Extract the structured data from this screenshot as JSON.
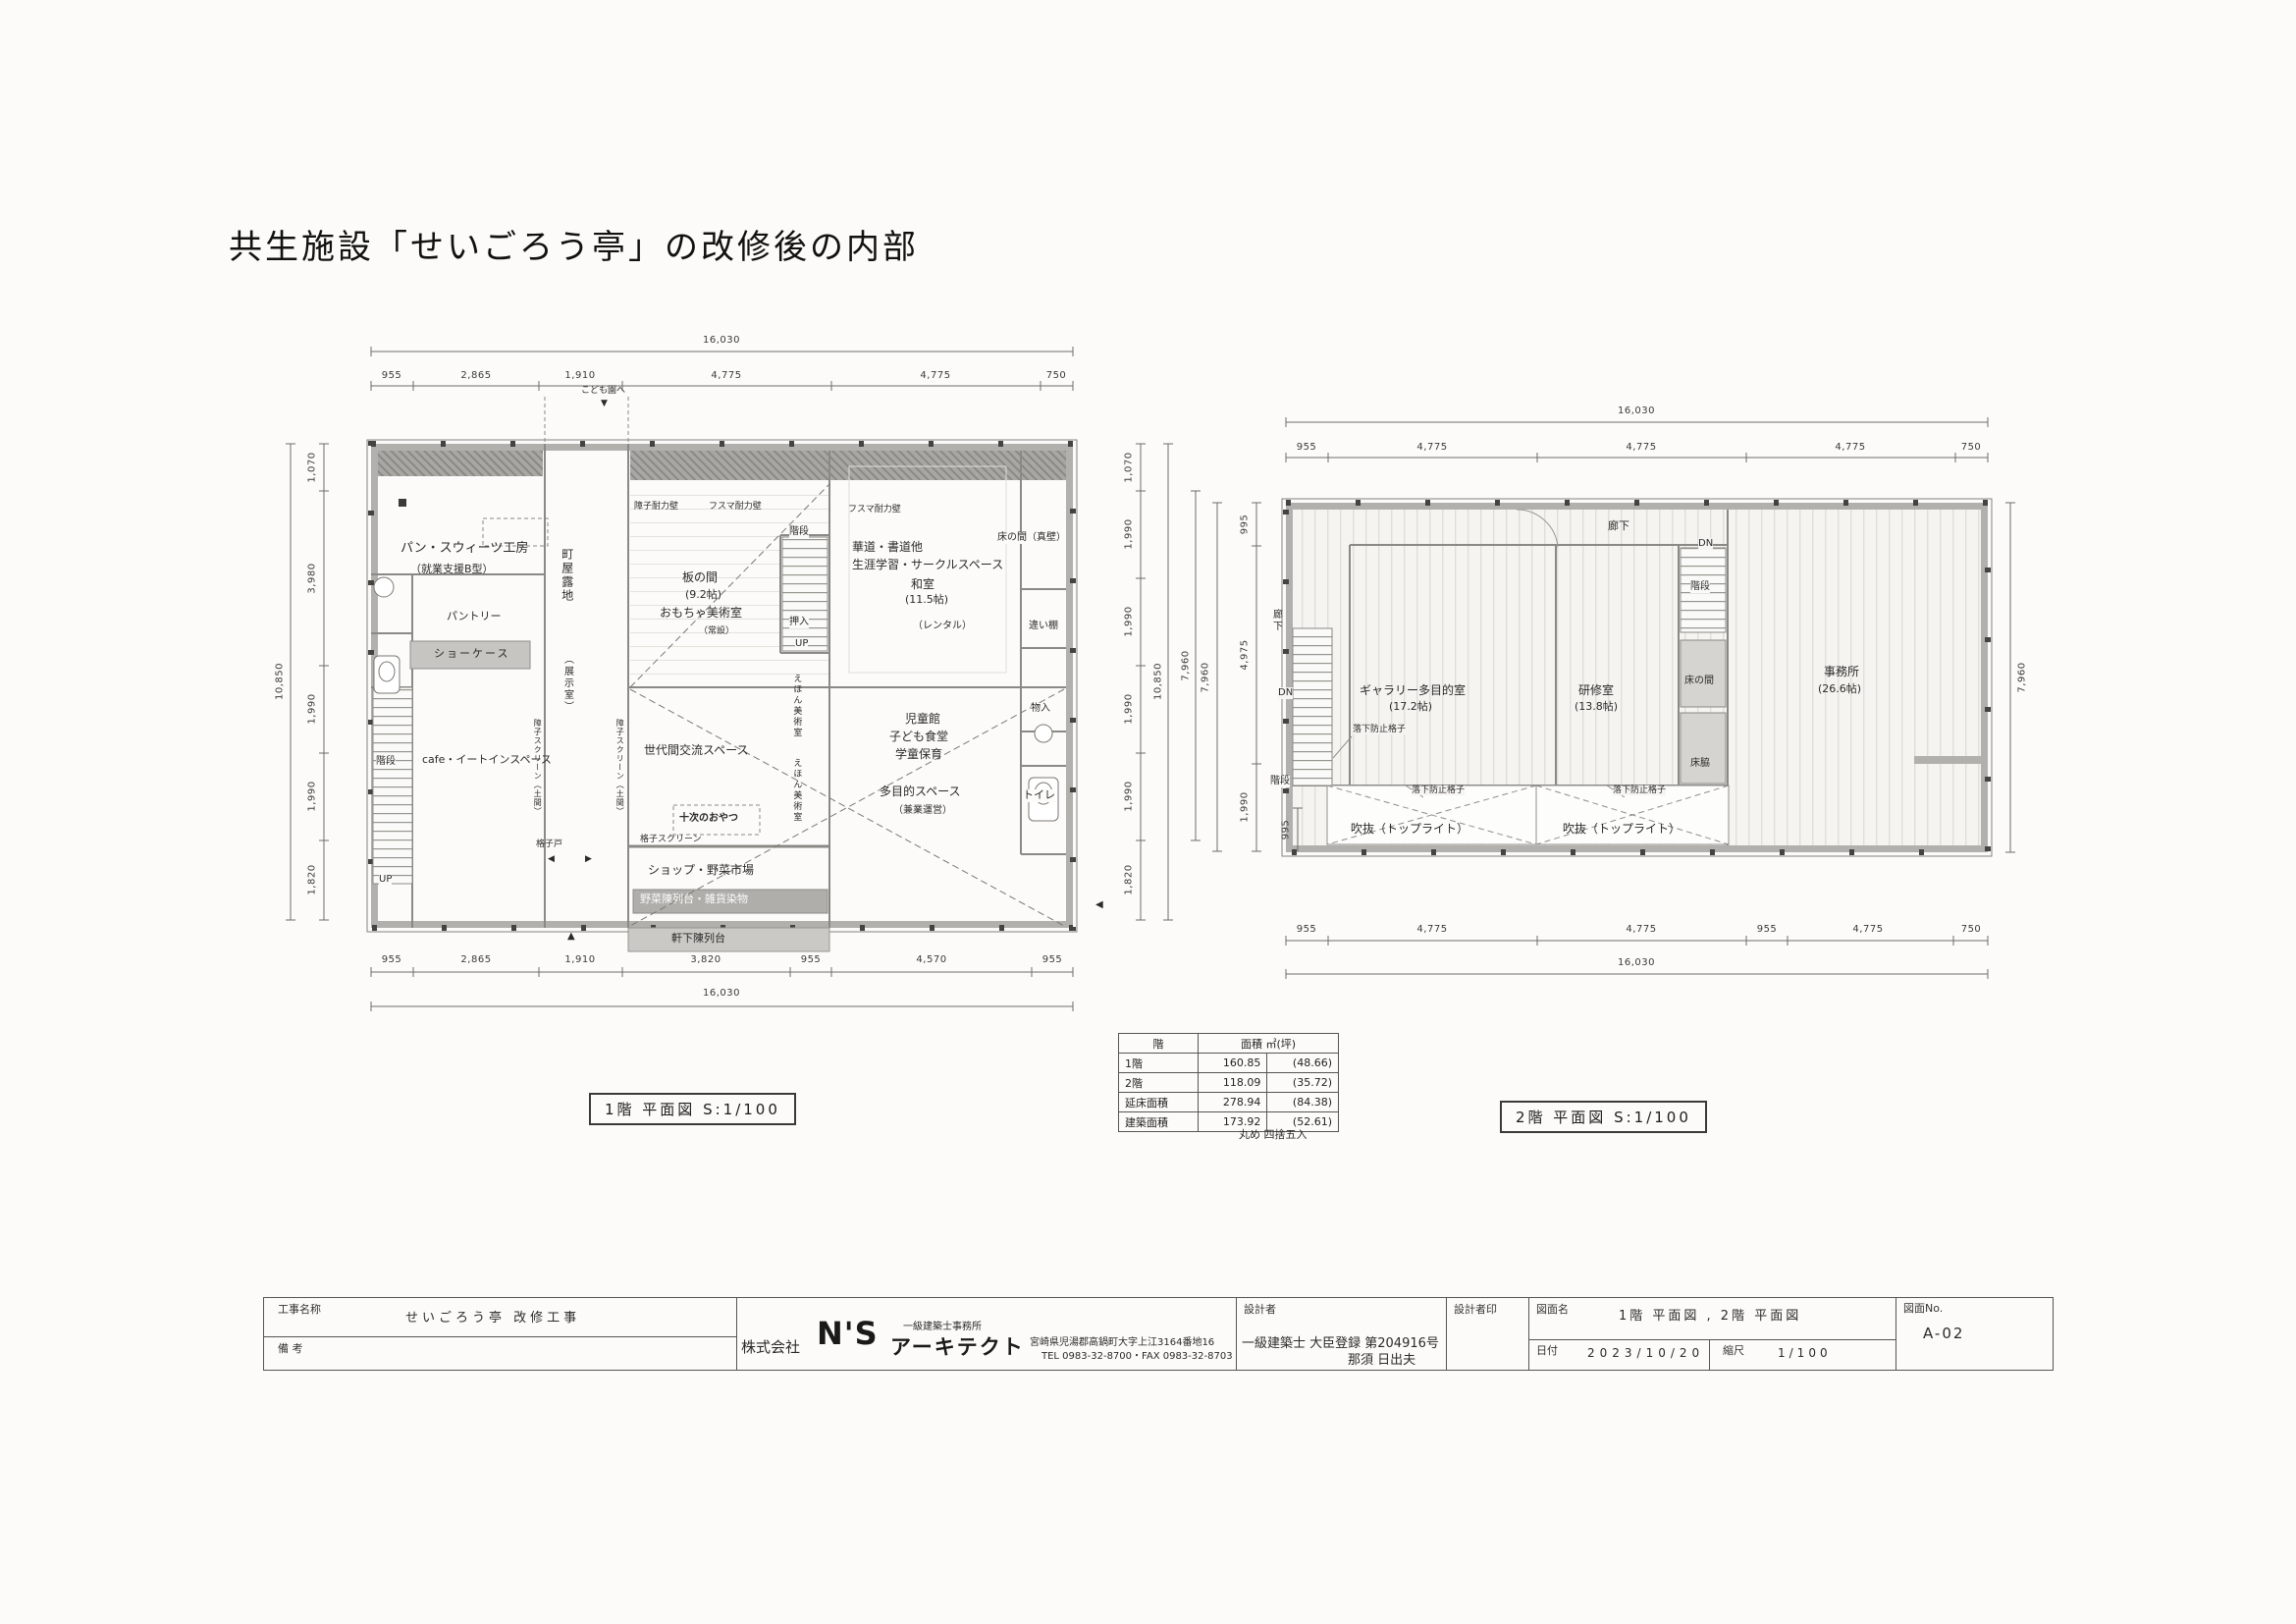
{
  "page": {
    "title": "共生施設「せいごろう亭」の改修後の内部"
  },
  "markers": {
    "down": "▼",
    "up": "▲",
    "left": "◀",
    "right": "▶",
    "square": "■"
  },
  "plan1": {
    "caption": "1階  平面図 S:1/100",
    "labels": {
      "kodomo_en": "こども園へ",
      "bread": "パン・スウィーツ工房",
      "bread_sub": "（就業支援B型）",
      "pantry": "パントリー",
      "showcase": "ショーケース",
      "cafe": "cafe・イートインスペース",
      "kaidan": "階段",
      "up": "UP",
      "machiya": "町屋露地",
      "machiya_sub": "（展示室）",
      "shoji_screen": "障子スクリーン（土間）",
      "itanoma": "板の間",
      "itanoma_size": "(9.2帖)",
      "toy": "おもちゃ美術室",
      "toy_sub": "（常設）",
      "kabe_shoji": "障子耐力壁",
      "kabe_fusuma": "フスマ耐力壁",
      "kado": "華道・書道他",
      "shogai": "生涯学習・サークルスペース",
      "washitsu": "和室",
      "washitsu_size": "(11.5帖)",
      "rental": "（レンタル）",
      "tokonoma": "床の間（真壁）",
      "chigaidana": "違い棚",
      "oshiire": "押入",
      "ehon": "えほん美術室",
      "jido": "児童館",
      "kodomo_shokudo": "子ども食堂",
      "gakudo": "学童保育",
      "monoire": "物入",
      "toilet": "トイレ",
      "sedaikan": "世代間交流スペース",
      "tamokuteki": "多目的スペース",
      "tamokuteki_sub": "（兼業運営）",
      "oyatsu": "十次のおやつ",
      "koshido": "格子戸",
      "koshi_screen": "格子スクリーン",
      "shop": "ショップ・野菜市場",
      "yasai": "野菜陳列台・雑貨染物",
      "nokishita": "軒下陳列台"
    },
    "dims": {
      "top_total": "16,030",
      "top": [
        "955",
        "2,865",
        "1,910",
        "4,775",
        "4,775",
        "750"
      ],
      "bottom": [
        "955",
        "2,865",
        "1,910",
        "3,820",
        "955",
        "4,570",
        "955"
      ],
      "bottom_total": "16,030",
      "left": [
        "1,070",
        "3,980",
        "1,990",
        "1,990",
        "1,820"
      ],
      "left_total": "10,850",
      "right": [
        "1,070",
        "1,990",
        "1,990",
        "1,990",
        "1,990",
        "1,820"
      ],
      "right_total1": "10,850",
      "right_total2": "7,960"
    }
  },
  "plan2": {
    "caption": "2階  平面図 S:1/100",
    "labels": {
      "rouka": "廊下",
      "dn": "DN",
      "kaidan": "階段",
      "gallery": "ギャラリー多目的室",
      "gallery_size": "(17.2帖)",
      "kenshu": "研修室",
      "kenshu_size": "(13.8帖)",
      "tokonoma": "床の間",
      "tokowaki": "床脇",
      "jimusho": "事務所",
      "jimusho_size": "(26.6帖)",
      "rakka": "落下防止格子",
      "fukinuke": "吹抜（トップライト）"
    },
    "dims": {
      "top_total": "16,030",
      "top": [
        "955",
        "4,775",
        "4,775",
        "4,775",
        "750"
      ],
      "bottom": [
        "955",
        "4,775",
        "4,775",
        "955",
        "4,775",
        "750"
      ],
      "bottom_total": "16,030",
      "left": [
        "995",
        "4,975",
        "1,990"
      ],
      "left_inner": "995",
      "left_total": "7,960",
      "right_total": "7,960"
    }
  },
  "area_table": {
    "header_floor": "階",
    "header_area": "面積  ㎡(坪)",
    "rows": [
      [
        "1階",
        "160.85",
        "(48.66)"
      ],
      [
        "2階",
        "118.09",
        "(35.72)"
      ],
      [
        "延床面積",
        "278.94",
        "(84.38)"
      ],
      [
        "建築面積",
        "173.92",
        "(52.61)"
      ]
    ],
    "note": "丸め 四捨五入"
  },
  "title_block": {
    "koji_label": "工事名称",
    "koji_value": "せいごろう亭  改修工事",
    "biko_label": "備  考",
    "company_prefix": "株式会社",
    "company_ns": "N'S",
    "company_office": "一級建築士事務所",
    "company_name": "アーキテクト",
    "company_addr": "宮崎県児湯郡高鍋町大字上江3164番地16",
    "company_tel": "TEL 0983-32-8700・FAX 0983-32-8703",
    "sekkei_label": "設計者",
    "sekkei_line1": "一級建築士  大臣登録 第204916号",
    "sekkei_line2": "那須  日出夫",
    "sekkeiin_label": "設計者印",
    "zumen_label": "図面名",
    "zumen_value": "1階  平面図 , 2階  平面図",
    "date_label": "日付",
    "date_value": "2023/10/20",
    "scale_label": "縮尺",
    "scale_value": "1/100",
    "no_label": "図面No.",
    "no_value": "A-02"
  }
}
